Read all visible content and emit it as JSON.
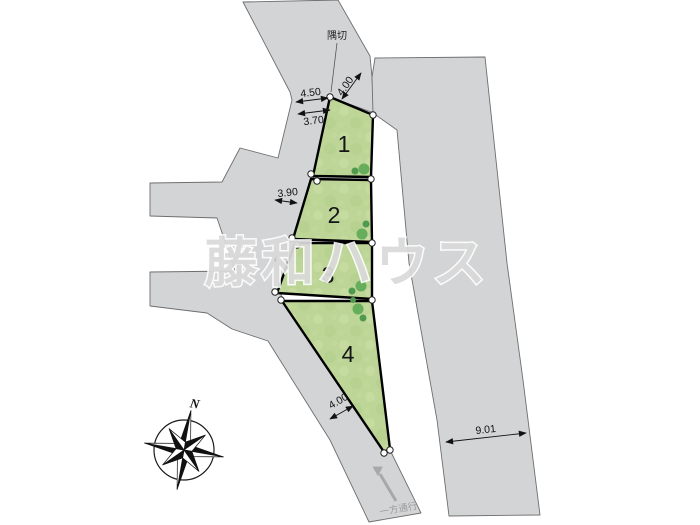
{
  "watermark": {
    "text": "藤和ハウス"
  },
  "labels": {
    "corner_cut": "隅切",
    "one_way_street": "一方通行",
    "compass_north": "N"
  },
  "lots": [
    {
      "number": "1"
    },
    {
      "number": "2"
    },
    {
      "number": "3"
    },
    {
      "number": "4"
    }
  ],
  "dimensions": {
    "top_road_width_outer": "4.50",
    "top_road_width_inner": "3.70",
    "corner_cut_road_width": "4.00",
    "west_road_width": "3.90",
    "southwest_road_width": "4.00",
    "east_road_width": "9.01"
  },
  "colors": {
    "background": "#ffffff",
    "road_fill": "#d3d4d6",
    "road_edge": "#6e6e6e",
    "lot_fill": "#bdd597",
    "lot_border": "#000000",
    "tree_dark": "#4f9a4e",
    "tree_light": "#67ae5c",
    "one_way_gray": "#9c9c9c"
  }
}
